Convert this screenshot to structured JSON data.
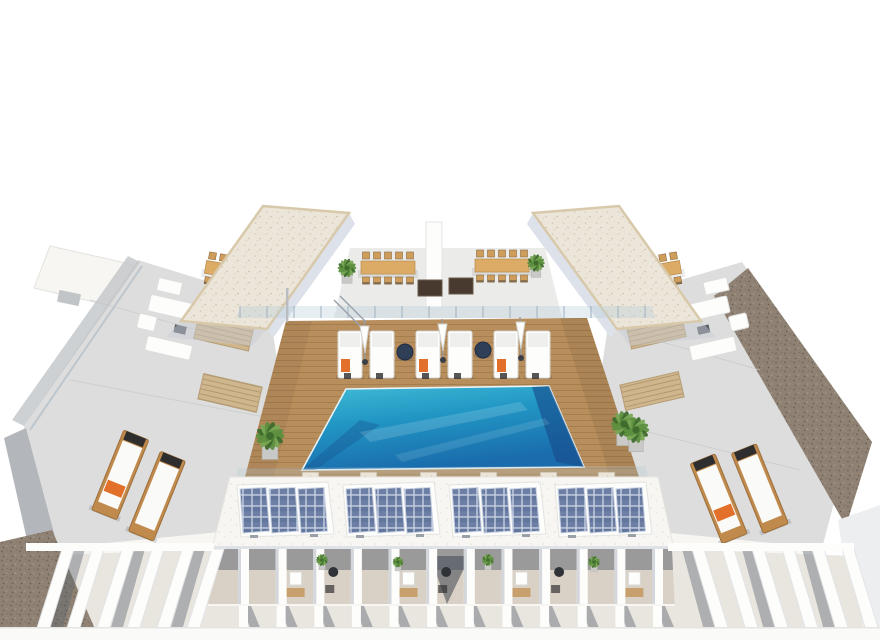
{
  "scene": {
    "alt": "Aerial three-quarter 3D architectural rendering of a white residential building rooftop: central swimming pool on a timber deck with sun loungers and closed parasols, two gravel-topped stair towers, communal dining tables with chairs, barbecue grills, flanking concrete terraces with sofas and timber loungers, a row of rooftop solar panel arrays, and penthouse balconies with angled white louver fins below",
    "view": "aerial-three-quarter",
    "background": "#ffffff"
  },
  "colors": {
    "background": "#ffffff",
    "white": "#fdfdfc",
    "white_warm": "#f7f6f3",
    "concrete": "#dcdddc",
    "concrete_dark": "#c2c5c8",
    "fascia_gray": "#b3b7bc",
    "tower_shade": "#dce1ea",
    "roof_speckle": "#ece5d9",
    "roof_trim": "#d8c9ab",
    "gravel_brown": "#8f8274",
    "gravel_dark": "#6e6357",
    "wood": "#b88e5c",
    "wood_dark": "#8f6a3e",
    "slat_tan": "#cfb68d",
    "slat_line": "#a9916a",
    "pool_light": "#41bcd6",
    "pool_mid": "#2196c4",
    "pool_deep": "#1a6cac",
    "pool_dark": "#174f8d",
    "glass_blue": "#b8cdd9",
    "navy_table": "#2e3f57",
    "orange_towel": "#e2702a",
    "timber_table": "#dcab66",
    "chair_wood": "#cf9d5b",
    "grill_dark": "#483a2f",
    "solar_blue": "#6d7fa5",
    "solar_blue_dark": "#4f6391",
    "solar_grid": "#c9d2e2",
    "tan_floor": "#d9d1c6",
    "floor_light": "#e9e5df",
    "shadow_blue": "#5c6470",
    "cushion_white": "#fafaf8",
    "lounger_wood": "#c08a4c",
    "plant_green": "#5d8f3f",
    "plant_dark": "#3f6b2d",
    "plant_light": "#79a855"
  },
  "objects": {
    "stair_towers": 2,
    "dining_tables": 4,
    "dining_chairs_per_table": 10,
    "barbecue_grills": 2,
    "deck_loungers": 6,
    "orange_towels": 3,
    "closed_umbrellas": 3,
    "pool_side_tables": 2,
    "wing_lounger_pairs": 2,
    "timber_slat_mats": 4,
    "sofa_groups": 2,
    "solar_arrays": 4,
    "solar_panels_per_array": 3,
    "balcony_pillars": 12,
    "louver_fins_left": 6,
    "louver_fins_right": 6,
    "deck_piers": 6,
    "railing_posts": 16,
    "plants": 9
  }
}
